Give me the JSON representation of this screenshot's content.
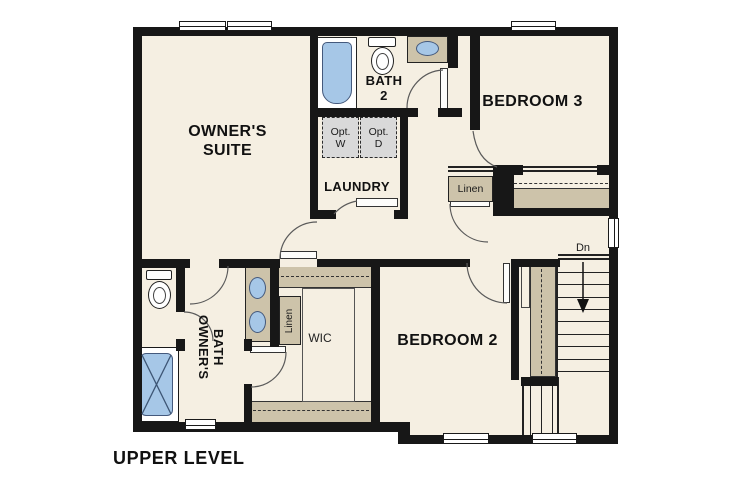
{
  "plan": {
    "title": "UPPER LEVEL",
    "rooms": {
      "owners_suite": {
        "line1": "OWNER'S",
        "line2": "SUITE"
      },
      "bedroom3": {
        "label": "BEDROOM 3"
      },
      "bedroom2": {
        "label": "BEDROOM 2"
      },
      "bath2": {
        "line1": "BATH",
        "line2": "2"
      },
      "laundry": {
        "label": "LAUNDRY"
      },
      "owners_bath": {
        "line1": "OWNER'S",
        "line2": "BATH"
      },
      "wic": {
        "label": "WIC"
      }
    },
    "closets": {
      "linen_hall": {
        "label": "Linen"
      },
      "linen_owners": {
        "label": "Linen"
      }
    },
    "laundry_appliances": {
      "washer": {
        "line1": "Opt.",
        "line2": "W"
      },
      "dryer": {
        "line1": "Opt.",
        "line2": "D"
      }
    },
    "stairs": {
      "down_label": "Dn"
    }
  },
  "colors": {
    "background": "#ffffff",
    "wall": "#171717",
    "floor": "#f5efe2",
    "casework_tan": "#cdc3aa",
    "fixture_blue": "#a6c7e7",
    "optional_appliance_gray": "#d9d9d9"
  }
}
